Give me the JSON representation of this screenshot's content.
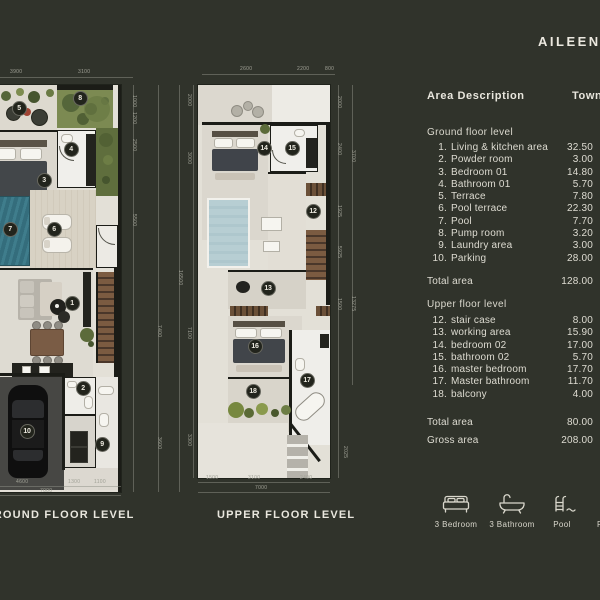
{
  "title": "AILEEN P",
  "panel": {
    "header_left": "Area Description",
    "header_right": "Townhouse",
    "ground": {
      "label": "Ground floor level",
      "rows": [
        {
          "n": "1.",
          "name": "Living & kitchen area",
          "v": "32.50"
        },
        {
          "n": "2.",
          "name": "Powder room",
          "v": "3.00"
        },
        {
          "n": "3.",
          "name": "Bedroom 01",
          "v": "14.80"
        },
        {
          "n": "4.",
          "name": "Bathroom 01",
          "v": "5.70"
        },
        {
          "n": "5.",
          "name": "Terrace",
          "v": "7.80"
        },
        {
          "n": "6.",
          "name": "Pool terrace",
          "v": "22.30"
        },
        {
          "n": "7.",
          "name": "Pool",
          "v": "7.70"
        },
        {
          "n": "8.",
          "name": "Pump room",
          "v": "3.20"
        },
        {
          "n": "9.",
          "name": "Laundry area",
          "v": "3.00"
        },
        {
          "n": "10.",
          "name": "Parking",
          "v": "28.00"
        }
      ],
      "total_label": "Total area",
      "total_value": "128.00"
    },
    "upper": {
      "label": "Upper floor level",
      "rows": [
        {
          "n": "12.",
          "name": "stair case",
          "v": "8.00"
        },
        {
          "n": "13.",
          "name": "working area",
          "v": "15.90"
        },
        {
          "n": "14.",
          "name": "bedroom 02",
          "v": "17.00"
        },
        {
          "n": "15.",
          "name": "bathroom 02",
          "v": "5.70"
        },
        {
          "n": "16.",
          "name": "master bedroom",
          "v": "17.70"
        },
        {
          "n": "17.",
          "name": "Master bathroom",
          "v": "11.70"
        },
        {
          "n": "18.",
          "name": "balcony",
          "v": "4.00"
        }
      ],
      "total_label": "Total area",
      "total_value": "80.00"
    },
    "gross_label": "Gross area",
    "gross_value": "208.00"
  },
  "plan_labels": {
    "ground": "GROUND FLOOR LEVEL",
    "upper": "UPPER FLOOR LEVEL"
  },
  "badges": {
    "ground": [
      "1",
      "2",
      "3",
      "4",
      "5",
      "6",
      "7",
      "8",
      "9",
      "10"
    ],
    "upper": [
      "12",
      "13",
      "14",
      "15",
      "16",
      "17",
      "18"
    ]
  },
  "legend": [
    {
      "icon": "bed-icon",
      "label": "3 Bedroom"
    },
    {
      "icon": "bathtub-icon",
      "label": "3 Bathroom"
    },
    {
      "icon": "pool-icon",
      "label": "Pool"
    },
    {
      "icon": "car-icon",
      "label": "Parking"
    }
  ],
  "dims": {
    "gt": [
      "3900",
      "3100"
    ],
    "gb": [
      "4600",
      "1300",
      "1100",
      "7000"
    ],
    "gr": [
      "1000",
      "1200",
      "2500",
      "5500",
      "7400",
      "3600",
      "16500"
    ],
    "ut": [
      "2600",
      "2200",
      "800"
    ],
    "ub": [
      "1500",
      "3100",
      "2400",
      "7000"
    ],
    "ul": [
      "2000",
      "3000",
      "7100",
      "3300"
    ],
    "ur": [
      "2000",
      "2400",
      "3700",
      "1925",
      "5925",
      "1500",
      "13275",
      "2025"
    ]
  },
  "colors": {
    "background": "#30332b",
    "paper": "#e3e0d7",
    "wall": "#1b1c17",
    "pool": "#36707f",
    "pool_void": "#b7ced3",
    "text": "#e8e6dd"
  }
}
